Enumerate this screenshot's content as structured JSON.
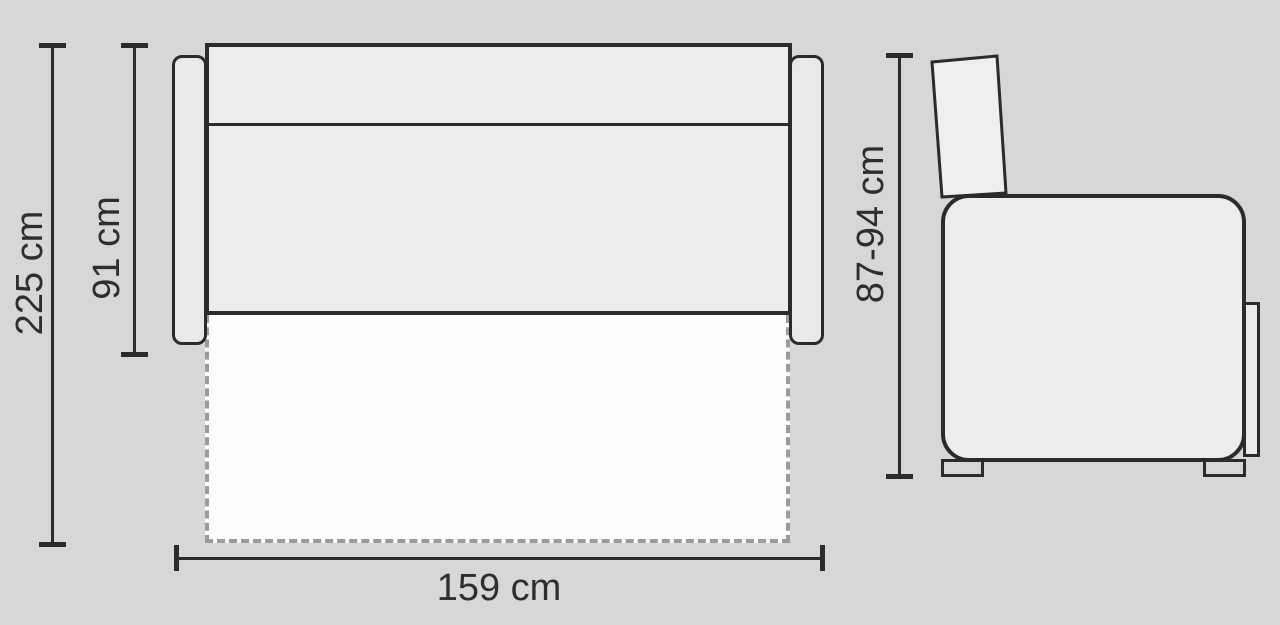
{
  "diagram": {
    "title": "sofa-bed dimension drawing",
    "views": {
      "top_view": "unfolded sofa bed seen from above",
      "side_view": "sofa seen from the side"
    },
    "dimensions": {
      "total_depth": {
        "label": "225 cm"
      },
      "seat_depth": {
        "label": "91 cm"
      },
      "width": {
        "label": "159 cm"
      },
      "height": {
        "label": "87-94 cm"
      }
    }
  },
  "colors": {
    "bg": "#d7d7d7",
    "sofa": "#ededed",
    "armrest": "#e9e9e9",
    "bed": "#fcfcfc",
    "line": "#2b2b2b",
    "dash": "#9b9b9b",
    "text": "#2e2e2e"
  }
}
